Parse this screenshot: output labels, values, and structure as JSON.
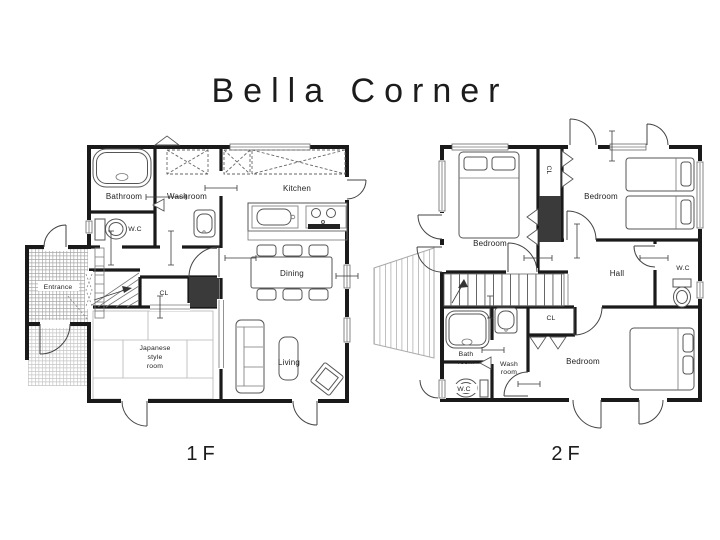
{
  "title": "Bella Corner",
  "floors": {
    "f1": {
      "label": "1F",
      "rooms": {
        "bathroom": "Bathroom",
        "washroom": "Washroom",
        "wc": "W.C",
        "kitchen": "Kitchen",
        "dining": "Dining",
        "living": "Living",
        "entrance": "Entrance",
        "closet": "CL",
        "japanese1": "Japanese",
        "japanese2": "style",
        "japanese3": "room"
      }
    },
    "f2": {
      "label": "2F",
      "rooms": {
        "bedroom_nw": "Bedroom",
        "bedroom_ne": "Bedroom",
        "bedroom_s": "Bedroom",
        "closet_top": "CL",
        "closet_s": "CL",
        "hall": "Hall",
        "wc_n": "W.C",
        "wc_s": "W.C",
        "bath1": "Bath",
        "bath2": "room",
        "wash1": "Wash",
        "wash2": "room"
      }
    }
  },
  "colors": {
    "walls": "#1a1a1a",
    "dark_fill": "#3a3a3a",
    "furniture_line": "#555555",
    "hatch_line": "#a8a8a8",
    "text": "#222222",
    "background": "#ffffff"
  }
}
